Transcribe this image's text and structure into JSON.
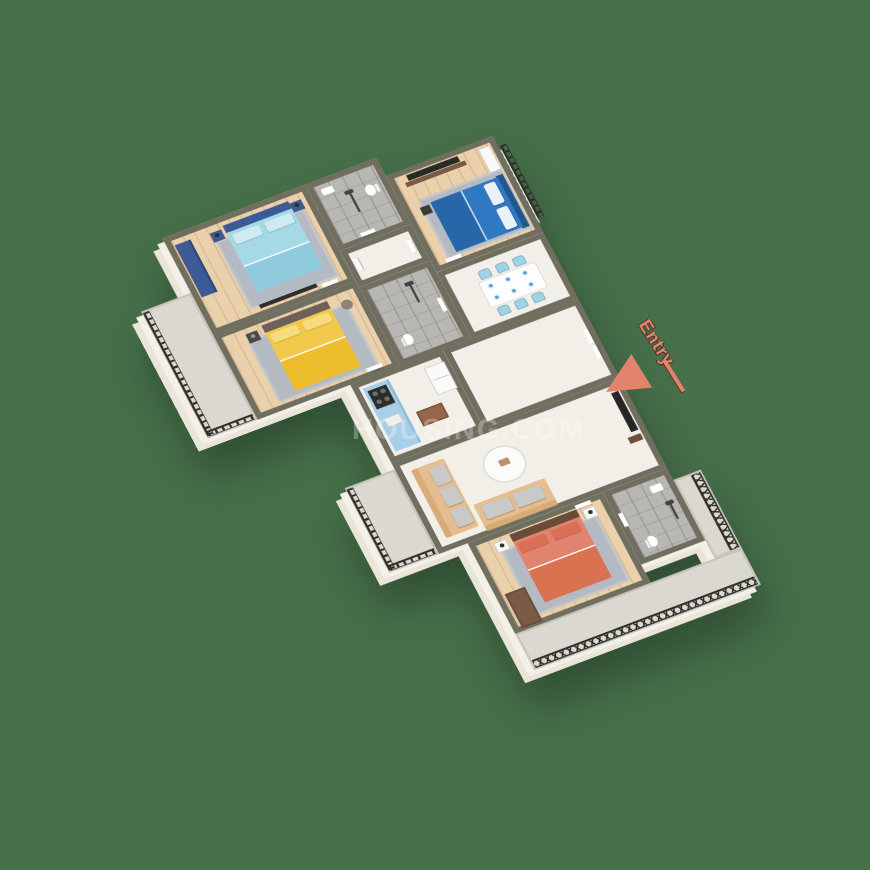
{
  "scene": {
    "description": "3D isometric floor-plan render of a four-bedroom apartment",
    "background_color": "#47704a",
    "watermark": {
      "text": "HOUSING.COM",
      "color": "#ffffff",
      "opacity": "0.28"
    },
    "entry_marker": {
      "label": "Entry",
      "color": "#e2836e",
      "shadow_color": "#53382e"
    }
  },
  "palette": {
    "wall_top": "#6f6e5f",
    "wall_face": "#f3f0e8",
    "wood_floor": "#ead0ab",
    "tile_floor": "#b8b7b3",
    "marble_floor": "#f2efe8",
    "balcony_floor": "#dbd8d1",
    "railing": "#2f2f2a",
    "rug": "#b4bac2",
    "door": "#ffffff"
  },
  "rooms": [
    {
      "id": "bedroom-master",
      "floor": "wood",
      "furniture": [
        "double-bed",
        "wardrobe",
        "nightstand",
        "nightstand",
        "table-lamp",
        "table-lamp",
        "rug",
        "wall-tv"
      ],
      "colors": {
        "bedding": "#a6d9e8",
        "frame": "#3b5a96",
        "pillow": "#cfeaf2",
        "blanket": "#8fcbdd"
      }
    },
    {
      "id": "bedroom-yellow",
      "floor": "wood",
      "furniture": [
        "double-bed",
        "nightstand",
        "stool",
        "rug"
      ],
      "colors": {
        "bedding": "#f2c84b",
        "headboard": "#6b6158",
        "pillow": "#f7dc7e",
        "blanket": "#eebd2e"
      }
    },
    {
      "id": "bedroom-blue",
      "floor": "wood",
      "furniture": [
        "double-bed",
        "tv-panel",
        "media-console",
        "wardrobe",
        "nightstand",
        "rug"
      ],
      "colors": {
        "bedding": "#2f78c2",
        "frame": "#24558c",
        "pillow": "#e8f2f8"
      }
    },
    {
      "id": "bedroom-coral",
      "floor": "wood",
      "furniture": [
        "double-bed",
        "wardrobe",
        "nightstand",
        "nightstand",
        "table-lamp",
        "table-lamp",
        "rug"
      ],
      "colors": {
        "bedding": "#e2836e",
        "headboard": "#6b4a38",
        "pillow": "#d96f55",
        "blanket": "#d97250"
      }
    },
    {
      "id": "bathroom-top",
      "floor": "tile",
      "furniture": [
        "toilet",
        "washbasin",
        "shower"
      ]
    },
    {
      "id": "bathroom-middle",
      "floor": "tile",
      "furniture": [
        "toilet",
        "shower"
      ]
    },
    {
      "id": "bathroom-bottom",
      "floor": "tile",
      "furniture": [
        "toilet",
        "washbasin",
        "shower"
      ]
    },
    {
      "id": "dining-area",
      "floor": "marble",
      "furniture": [
        "dining-table",
        "chair",
        "chair",
        "chair",
        "chair",
        "chair",
        "chair",
        "plates"
      ],
      "colors": {
        "chairs": "#9fd3e3",
        "table": "#fdfdfd"
      }
    },
    {
      "id": "kitchen",
      "floor": "marble",
      "furniture": [
        "counter",
        "hob",
        "sink",
        "fridge",
        "floor-mat"
      ],
      "colors": {
        "counter": "#a8cfe8",
        "hob": "#2d2d2b",
        "mat": "#96664a"
      }
    },
    {
      "id": "foyer",
      "floor": "marble",
      "furniture": [
        "entry-double-door"
      ]
    },
    {
      "id": "living-room",
      "floor": "marble",
      "furniture": [
        "sofa-three-seat",
        "sofa-two-seat",
        "coffee-table",
        "tv-panel",
        "media-console"
      ],
      "colors": {
        "sofa": "#e5bd8e",
        "cushion": "#c9c9c9",
        "table": "#fbfbf9"
      }
    },
    {
      "id": "balcony-left-top",
      "floor": "concrete",
      "furniture": [
        "railing"
      ]
    },
    {
      "id": "balcony-left-bottom",
      "floor": "concrete",
      "furniture": [
        "railing"
      ]
    },
    {
      "id": "balcony-bottom",
      "floor": "concrete",
      "furniture": [
        "railing-lattice"
      ]
    },
    {
      "id": "balcony-right",
      "floor": "concrete",
      "furniture": [
        "railing-lattice"
      ]
    }
  ]
}
